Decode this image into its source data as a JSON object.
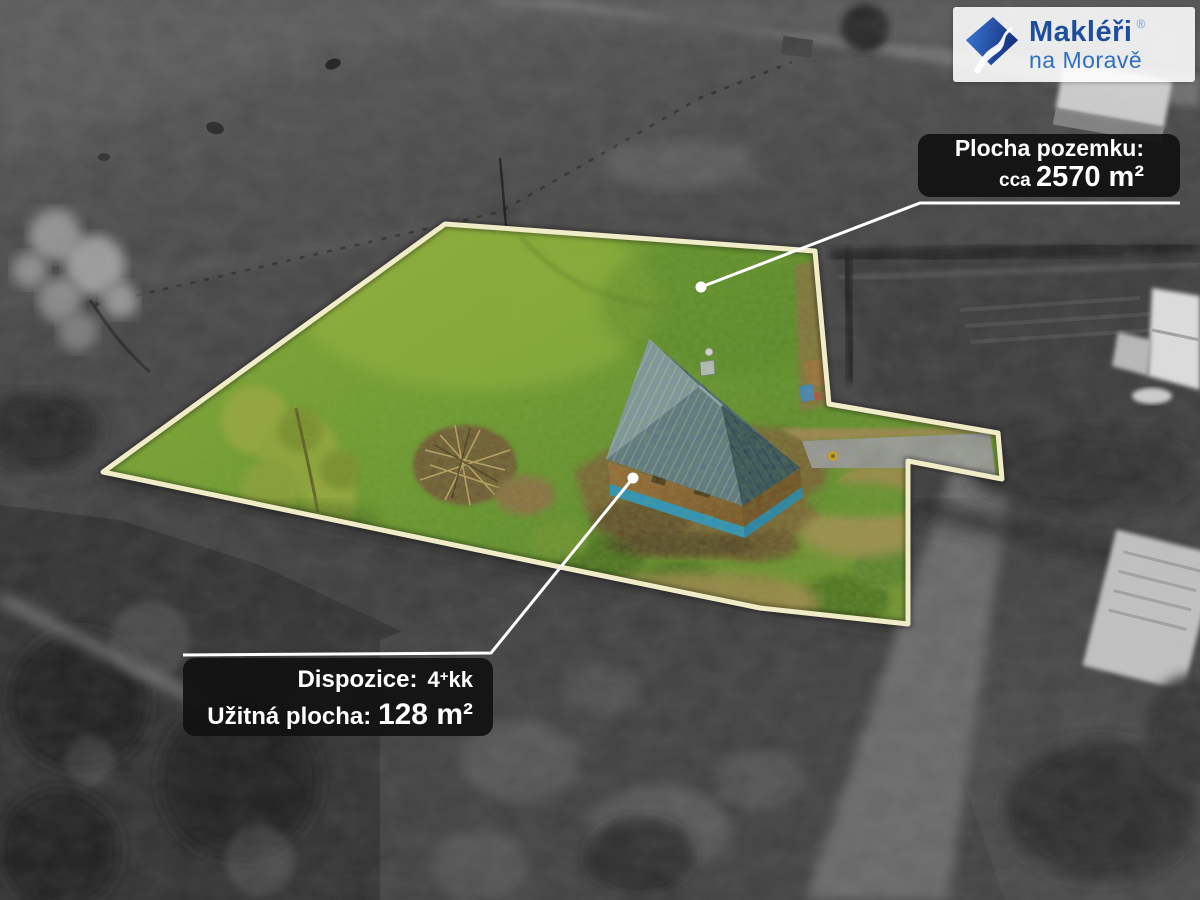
{
  "brand": {
    "line1": "Makléři",
    "registered": "®",
    "line2": "na Moravě"
  },
  "plot_label": {
    "title": "Plocha pozemku:",
    "prefix": "cca",
    "value": "2570 m²"
  },
  "house_label": {
    "l1_label": "Dispozice:",
    "l1_num": "4",
    "l1_plus": "+",
    "l1_rooms": "kk",
    "l2_label": "Užitná plocha:",
    "l2_value": "128 m²"
  },
  "icons": {
    "brand_logo": "river-diamond-icon",
    "plot_marker": "marker-dot",
    "house_marker": "marker-dot"
  },
  "colors": {
    "boundary_line": "#f2eec9",
    "leader_line": "#ffffff",
    "label_bg": "rgba(17,17,17,0.93)",
    "label_text": "#ffffff",
    "brand_blue_dark": "#1d4e9e",
    "brand_blue_light": "#2f6fbe",
    "brand_badge_bg": "rgba(255,255,255,0.88)",
    "grass_green": "#6a9130",
    "roof_blue": "#44607a",
    "wall_brown": "#96612f",
    "plinth_blue": "#2590c4"
  }
}
